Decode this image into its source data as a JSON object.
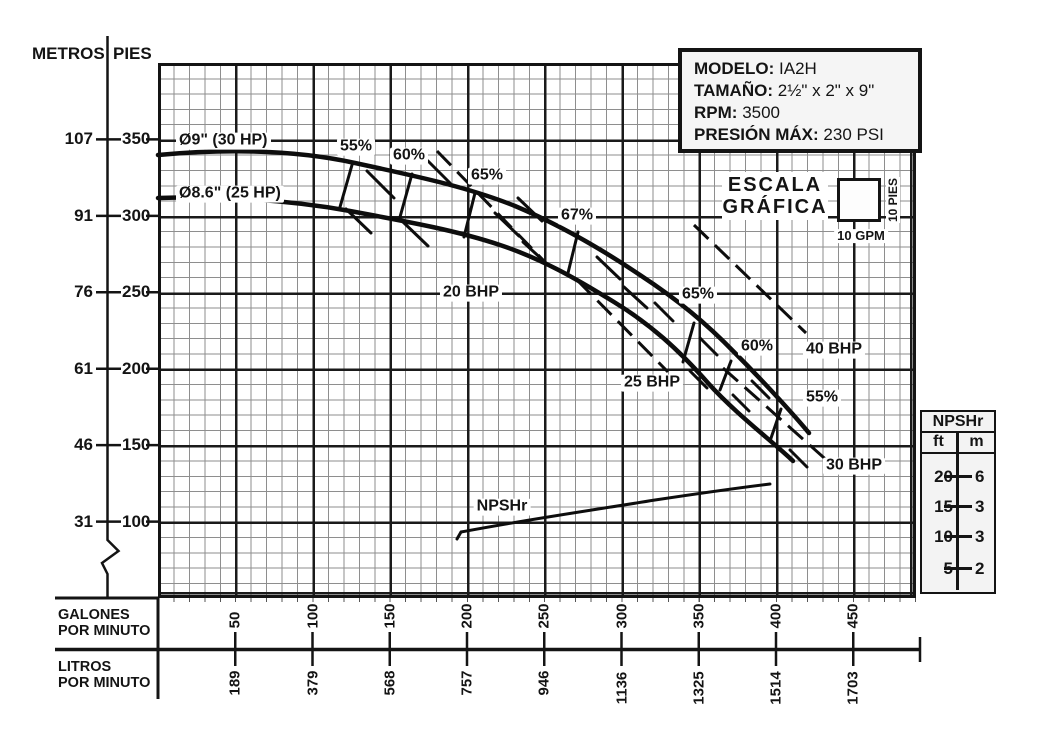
{
  "axis_left": {
    "header_metros": "METROS",
    "header_pies": "PIES",
    "rows": [
      {
        "metros": "107",
        "pies": "350"
      },
      {
        "metros": "91",
        "pies": "300"
      },
      {
        "metros": "76",
        "pies": "250"
      },
      {
        "metros": "61",
        "pies": "200"
      },
      {
        "metros": "46",
        "pies": "150"
      },
      {
        "metros": "31",
        "pies": "100"
      }
    ]
  },
  "axis_bottom": {
    "gpm_label_line1": "GALONES",
    "gpm_label_line2": "POR MINUTO",
    "lpm_label_line1": "LITROS",
    "lpm_label_line2": "POR MINUTO",
    "ticks": [
      {
        "gpm": "50",
        "lpm": "189"
      },
      {
        "gpm": "100",
        "lpm": "379"
      },
      {
        "gpm": "150",
        "lpm": "568"
      },
      {
        "gpm": "200",
        "lpm": "757"
      },
      {
        "gpm": "250",
        "lpm": "946"
      },
      {
        "gpm": "300",
        "lpm": "1136"
      },
      {
        "gpm": "350",
        "lpm": "1325"
      },
      {
        "gpm": "400",
        "lpm": "1514"
      },
      {
        "gpm": "450",
        "lpm": "1703"
      }
    ]
  },
  "info_box": {
    "rows": [
      {
        "label": "MODELO:",
        "value": "IA2H"
      },
      {
        "label": "TAMAÑO:",
        "value": "2½\" x 2\" x 9\""
      },
      {
        "label": "RPM:",
        "value": "3500"
      },
      {
        "label": "PRESIÓN MÁX:",
        "value": "230 PSI"
      }
    ]
  },
  "scale_legend": {
    "line1": "ESCALA",
    "line2": "GRÁFICA",
    "x_label": "10 GPM",
    "y_label": "10 PIES"
  },
  "npshr_table": {
    "title": "NPSHr",
    "col_ft": "ft",
    "col_m": "m",
    "rows": [
      {
        "ft": "20",
        "m": "6"
      },
      {
        "ft": "15",
        "m": "3"
      },
      {
        "ft": "10",
        "m": "3"
      },
      {
        "ft": "5",
        "m": "2"
      }
    ]
  },
  "annotations": [
    {
      "text": "Ø9\" (30 HP)",
      "x": 176,
      "y": 141,
      "ha": "left"
    },
    {
      "text": "Ø8.6\" (25 HP)",
      "x": 176,
      "y": 194,
      "ha": "left"
    },
    {
      "text": "55%",
      "x": 356,
      "y": 147
    },
    {
      "text": "60%",
      "x": 409,
      "y": 156
    },
    {
      "text": "65%",
      "x": 487,
      "y": 176
    },
    {
      "text": "67%",
      "x": 577,
      "y": 216
    },
    {
      "text": "65%",
      "x": 698,
      "y": 295
    },
    {
      "text": "60%",
      "x": 757,
      "y": 347
    },
    {
      "text": "55%",
      "x": 822,
      "y": 398
    },
    {
      "text": "20 BHP",
      "x": 471,
      "y": 293
    },
    {
      "text": "25 BHP",
      "x": 652,
      "y": 383
    },
    {
      "text": "40 BHP",
      "x": 834,
      "y": 350
    },
    {
      "text": "30 BHP",
      "x": 854,
      "y": 466
    },
    {
      "text": "NPSHr",
      "x": 502,
      "y": 507
    }
  ],
  "chart_data": {
    "type": "line",
    "title": "Curva de desempeño de bomba IA2H",
    "xlabel": "GALONES POR MINUTO",
    "xlabel_secondary": "LITROS POR MINUTO",
    "ylabel": "PIES",
    "ylabel_secondary": "METROS",
    "x_ticks_gpm": [
      50,
      100,
      150,
      200,
      250,
      300,
      350,
      400,
      450
    ],
    "x_ticks_lpm": [
      189,
      379,
      568,
      757,
      946,
      1136,
      1325,
      1514,
      1703
    ],
    "y_ticks_pies": [
      350,
      300,
      250,
      200,
      150,
      100
    ],
    "y_ticks_metros": [
      107,
      91,
      76,
      61,
      46,
      31
    ],
    "ylim_pies": [
      50,
      400
    ],
    "grid": true,
    "grid_minor_step": {
      "gpm": 10,
      "pies": 10
    },
    "series": [
      {
        "name": "Ø9\" (30 HP)",
        "style": "solid-thick",
        "unit_y": "pies",
        "points": [
          [
            0,
            340
          ],
          [
            60,
            342
          ],
          [
            110,
            336
          ],
          [
            157,
            329
          ],
          [
            200,
            319
          ],
          [
            240,
            301
          ],
          [
            273,
            284
          ],
          [
            306,
            266
          ],
          [
            338,
            242
          ],
          [
            364,
            217
          ],
          [
            386,
            193
          ],
          [
            406,
            173
          ],
          [
            421,
            159
          ]
        ]
      },
      {
        "name": "Ø8.6\" (25 HP)",
        "style": "solid-thick",
        "unit_y": "pies",
        "points": [
          [
            0,
            312
          ],
          [
            60,
            310
          ],
          [
            110,
            305
          ],
          [
            157,
            297
          ],
          [
            200,
            287
          ],
          [
            240,
            266
          ],
          [
            273,
            251
          ],
          [
            299,
            237
          ],
          [
            325,
            214
          ],
          [
            351,
            193
          ],
          [
            377,
            172
          ],
          [
            396,
            156
          ],
          [
            410,
            140
          ]
        ]
      },
      {
        "name": "NPSHr",
        "style": "solid-thin",
        "unit_y": "ft NPSH (escala derecha)",
        "points": [
          [
            200,
            10
          ],
          [
            250,
            11
          ],
          [
            300,
            13
          ],
          [
            350,
            15
          ],
          [
            400,
            17
          ]
        ]
      }
    ],
    "efficiency_labels": [
      {
        "value": "55%",
        "gpm": 125
      },
      {
        "value": "60%",
        "gpm": 162
      },
      {
        "value": "65%",
        "gpm": 205
      },
      {
        "value": "67%",
        "gpm": 270
      },
      {
        "value": "65%",
        "gpm": 345
      },
      {
        "value": "60%",
        "gpm": 372
      },
      {
        "value": "55%",
        "gpm": 402
      }
    ],
    "bhp_lines": [
      {
        "value": "20 BHP"
      },
      {
        "value": "25 BHP"
      },
      {
        "value": "30 BHP"
      },
      {
        "value": "40 BHP"
      }
    ],
    "legend_scale": "1 cuadro = 10 GPM x 10 PIES"
  }
}
